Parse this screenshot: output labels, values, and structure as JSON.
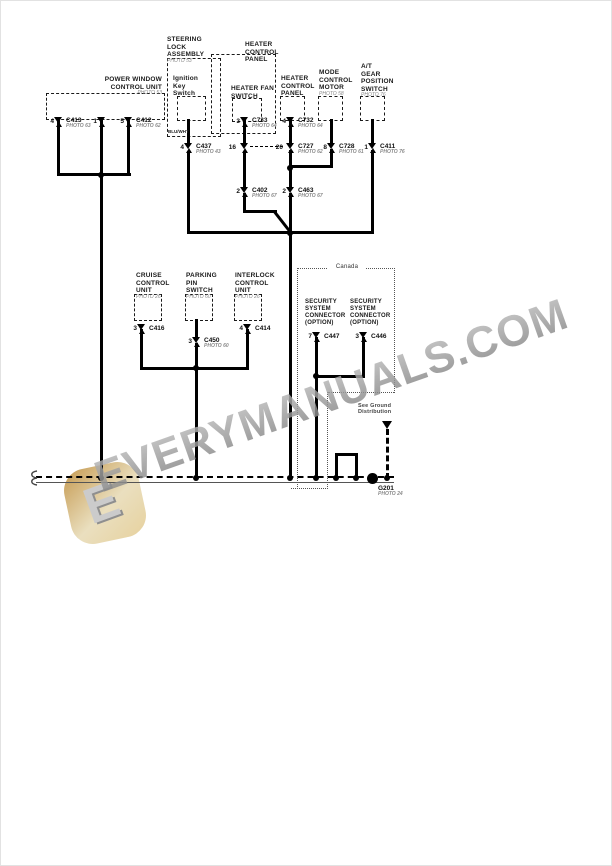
{
  "components": {
    "power_window_control_unit": {
      "name": "POWER WINDOW\nCONTROL UNIT",
      "photo": "PHOTO 53"
    },
    "steering_lock_assembly": {
      "name": "STEERING\nLOCK\nASSEMBLY",
      "photo": "PHOTO 53"
    },
    "ignition_key_switch": {
      "name": "Ignition\nKey\nSwitch"
    },
    "heater_control_panel_assembly": {
      "name": "HEATER\nCONTROL\nPANEL"
    },
    "heater_fan_switch": {
      "name": "HEATER FAN\nSWITCH"
    },
    "heater_control_panel": {
      "name": "HEATER\nCONTROL\nPANEL"
    },
    "mode_control_motor": {
      "name": "MODE\nCONTROL\nMOTOR",
      "photo": "PHOTO 58"
    },
    "at_gear_position_switch": {
      "name": "A/T\nGEAR\nPOSITION\nSWITCH",
      "photo": "PHOTO 76"
    },
    "cruise_control_unit": {
      "name": "CRUISE\nCONTROL\nUNIT",
      "photo": "PHOTO 26"
    },
    "parking_pin_switch": {
      "name": "PARKING\nPIN\nSWITCH",
      "photo": "PHOTO 60"
    },
    "interlock_control_unit": {
      "name": "INTERLOCK\nCONTROL\nUNIT",
      "photo": "PHOTO 26"
    },
    "security_system_connector_1": {
      "name": "SECURITY\nSYSTEM\nCONNECTOR\n(OPTION)"
    },
    "security_system_connector_2": {
      "name": "SECURITY\nSYSTEM\nCONNECTOR\n(OPTION)"
    }
  },
  "region": {
    "canada_label": "Canada"
  },
  "connectors": {
    "c413": {
      "pin": "4",
      "name": "C413",
      "photo": "PHOTO 63"
    },
    "pw_pin1": {
      "pin": "1"
    },
    "c412": {
      "pin": "5",
      "name": "C412",
      "photo": "PHOTO 62"
    },
    "c733": {
      "pin": "3",
      "name": "C733",
      "photo": "PHOTO 64"
    },
    "c732": {
      "pin": "4",
      "name": "C732",
      "photo": "PHOTO 64"
    },
    "c437": {
      "pin": "4",
      "name": "C437",
      "photo": "PHOTO 43"
    },
    "hcp_pin16": {
      "pin": "16"
    },
    "c727": {
      "pin": "20",
      "name": "C727",
      "photo": "PHOTO 62"
    },
    "c728": {
      "pin": "8",
      "name": "C728",
      "photo": "PHOTO 61"
    },
    "c411": {
      "pin": "1",
      "name": "C411",
      "photo": "PHOTO 76"
    },
    "c402": {
      "pin": "2",
      "name": "C402",
      "photo": "PHOTO 67"
    },
    "c463": {
      "pin": "2",
      "name": "C463",
      "photo": "PHOTO 67"
    },
    "c416": {
      "pin": "3",
      "name": "C416"
    },
    "c450": {
      "pin": "3",
      "name": "C450",
      "photo": "PHOTO 60"
    },
    "c414": {
      "pin": "4",
      "name": "C414"
    },
    "c447": {
      "pin": "7",
      "name": "C447"
    },
    "c446": {
      "pin": "3",
      "name": "C446"
    }
  },
  "wire_labels": {
    "ignition_wire_color": "BLU/WHT"
  },
  "ground": {
    "note": "See Ground\nDistribution",
    "point": "G201",
    "photo": "PHOTO 24"
  },
  "watermark": {
    "text": "EVERYMANUALS.COM",
    "logo_letter": "E",
    "logo_color": "#e2c28a",
    "text_color": "#8c8c8c"
  }
}
